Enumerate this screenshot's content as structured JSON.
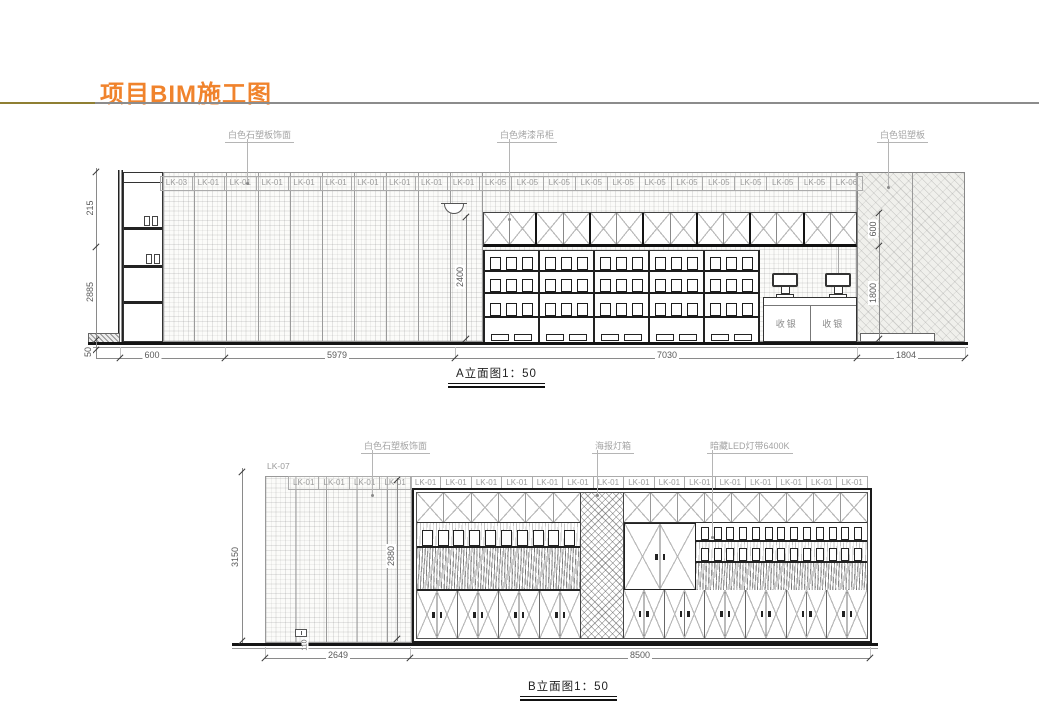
{
  "page": {
    "title": "项目BIM施工图"
  },
  "colors": {
    "accent": "#f0832c",
    "drawing_line": "#222222",
    "cad_label": "#9a9a9a"
  },
  "elevation_a": {
    "caption": "A立面图1：50",
    "callouts": [
      {
        "label": "白色石塑板饰面"
      },
      {
        "label": "白色烤漆吊柜"
      },
      {
        "label": "白色铝塑板"
      }
    ],
    "panel_labels": [
      "LK-03",
      "LK-01",
      "LK-01",
      "LK-01",
      "LK-01",
      "LK-01",
      "LK-01",
      "LK-01",
      "LK-01",
      "LK-01",
      "LK-05",
      "LK-05",
      "LK-05",
      "LK-05",
      "LK-05",
      "LK-05",
      "LK-05",
      "LK-05",
      "LK-05",
      "LK-05",
      "LK-05",
      "LK-06"
    ],
    "cashier_labels": [
      "收银",
      "收银"
    ],
    "dims": {
      "v_left": [
        "215",
        "2885",
        "50"
      ],
      "v_mid": "2400",
      "v_right": [
        "600",
        "1800"
      ],
      "h_bottom": [
        "600",
        "5979",
        "7030",
        "1804"
      ]
    }
  },
  "elevation_b": {
    "caption": "B立面图1：50",
    "corner_label": "LK-07",
    "callouts": [
      {
        "label": "白色石塑板饰面"
      },
      {
        "label": "海报灯箱"
      },
      {
        "label": "暗藏LED灯带6400K"
      }
    ],
    "panel_labels": [
      "LK-01",
      "LK-01",
      "LK-01",
      "LK-01",
      "LK-01",
      "LK-01",
      "LK-01",
      "LK-01",
      "LK-01",
      "LK-01",
      "LK-01",
      "LK-01",
      "LK-01",
      "LK-01",
      "LK-01",
      "LK-01",
      "LK-01",
      "LK-01",
      "LK-01"
    ],
    "dims": {
      "v_left": "3150",
      "v_inner": "2880",
      "v_small": "110",
      "h_bottom": [
        "2649",
        "8500"
      ]
    }
  }
}
